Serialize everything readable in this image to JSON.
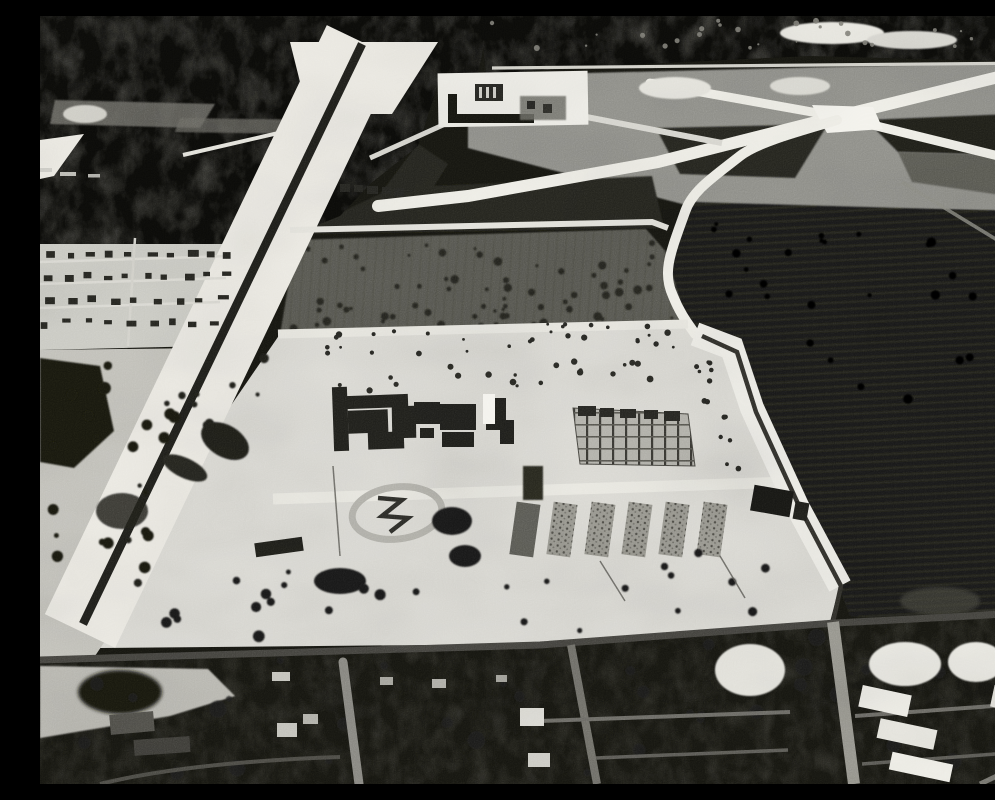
{
  "meta": {
    "title": "Aerial photograph",
    "alt_text": "Black-and-white oblique aerial photograph of a large cleared construction site with buildings under framing, bounded by a diagonal drainage canal on the left, intersecting white roads and a small airfield complex at top, dark cultivated fields on the right, and a dark tree-covered residential street grid across the bottom.",
    "description": "High-contrast monochrome aerial view: a bright sandy construction zone in mid-frame with two building complexes, rows of foundation slabs, an oval grading track and a barracks; a straight canal with white spoil banks runs diagonally from top center to lower left; runway-like roads cross in an X at upper right near a small building pad; dense black vegetation bands the top and bottom edges, with gray streets and white rooftops in the bottom residential grid and striped dark farmland on the right."
  },
  "palette": {
    "black": "#0a0a08",
    "residential_black": "#0b0b09",
    "ground_light": "#dbdad4",
    "corridor_white": "#edebe4",
    "road_white": "#f0efe8",
    "road_gray": "#8a8983",
    "open_gray": "#90908a",
    "orchard_gray": "#56564f",
    "field_dark": "#191915",
    "building_dark": "#1d1d19"
  },
  "image": {
    "scatter": {
      "orchard_trees": {
        "seed": 7,
        "count": 72,
        "min": 1.5,
        "max": 4.5,
        "color": "#20201b",
        "poly": [
          [
            258,
            226
          ],
          [
            604,
            215
          ],
          [
            624,
            238
          ],
          [
            644,
            306
          ],
          [
            244,
            318
          ]
        ]
      },
      "rfield_trees": {
        "seed": 13,
        "count": 26,
        "min": 2,
        "max": 5,
        "color": "#040403",
        "poly": [
          [
            662,
            200
          ],
          [
            958,
            210
          ],
          [
            928,
            420
          ],
          [
            700,
            342
          ]
        ]
      },
      "apron_trees": {
        "seed": 21,
        "count": 26,
        "min": 2.5,
        "max": 6,
        "color": "#171713",
        "poly": [
          [
            72,
            548
          ],
          [
            738,
            532
          ],
          [
            786,
            596
          ],
          [
            500,
            618
          ],
          [
            64,
            630
          ]
        ]
      },
      "left_trees": {
        "seed": 31,
        "count": 20,
        "min": 2.5,
        "max": 6.5,
        "color": "#141410",
        "poly": [
          [
            6,
            340
          ],
          [
            158,
            345
          ],
          [
            104,
            555
          ],
          [
            6,
            550
          ]
        ]
      },
      "bank_trees": {
        "seed": 41,
        "count": 12,
        "min": 2,
        "max": 5,
        "color": "#1a1a16",
        "poly": [
          [
            150,
            330
          ],
          [
            248,
            332
          ],
          [
            92,
            600
          ],
          [
            44,
            588
          ]
        ]
      },
      "equip_row1": {
        "seed": 51,
        "count": 30,
        "min": 1.2,
        "max": 3.2,
        "color": "#242420",
        "poly": [
          [
            250,
            314
          ],
          [
            640,
            305
          ],
          [
            642,
            332
          ],
          [
            252,
            342
          ]
        ]
      },
      "equip_row2": {
        "seed": 61,
        "count": 20,
        "min": 1.5,
        "max": 3.5,
        "color": "#262621",
        "poly": [
          [
            280,
            350
          ],
          [
            630,
            342
          ],
          [
            632,
            370
          ],
          [
            282,
            376
          ]
        ]
      },
      "east_dots": {
        "seed": 71,
        "count": 14,
        "min": 1.5,
        "max": 3,
        "color": "#23231f",
        "poly": [
          [
            648,
            325
          ],
          [
            668,
            322
          ],
          [
            702,
            465
          ],
          [
            680,
            468
          ]
        ]
      },
      "res_blobs": {
        "seed": 81,
        "count": 34,
        "min": 3,
        "max": 9,
        "color": "#1c1c18",
        "opacity": 0.8,
        "poly": [
          [
            6,
            656
          ],
          [
            985,
            606
          ],
          [
            985,
            758
          ],
          [
            6,
            758
          ]
        ]
      },
      "top_specks": {
        "seed": 91,
        "count": 26,
        "min": 1,
        "max": 3,
        "color": "#7e7d75",
        "opacity": 0.9,
        "poly": [
          [
            450,
            4
          ],
          [
            940,
            4
          ],
          [
            940,
            30
          ],
          [
            450,
            34
          ]
        ]
      }
    },
    "house_rows": [
      {
        "y": 236,
        "x0": 8,
        "x1": 185,
        "n": 10
      },
      {
        "y": 258,
        "x0": 6,
        "x1": 182,
        "n": 10
      },
      {
        "y": 281,
        "x0": 4,
        "x1": 178,
        "n": 9
      },
      {
        "y": 304,
        "x0": 2,
        "x1": 172,
        "n": 9
      }
    ]
  }
}
